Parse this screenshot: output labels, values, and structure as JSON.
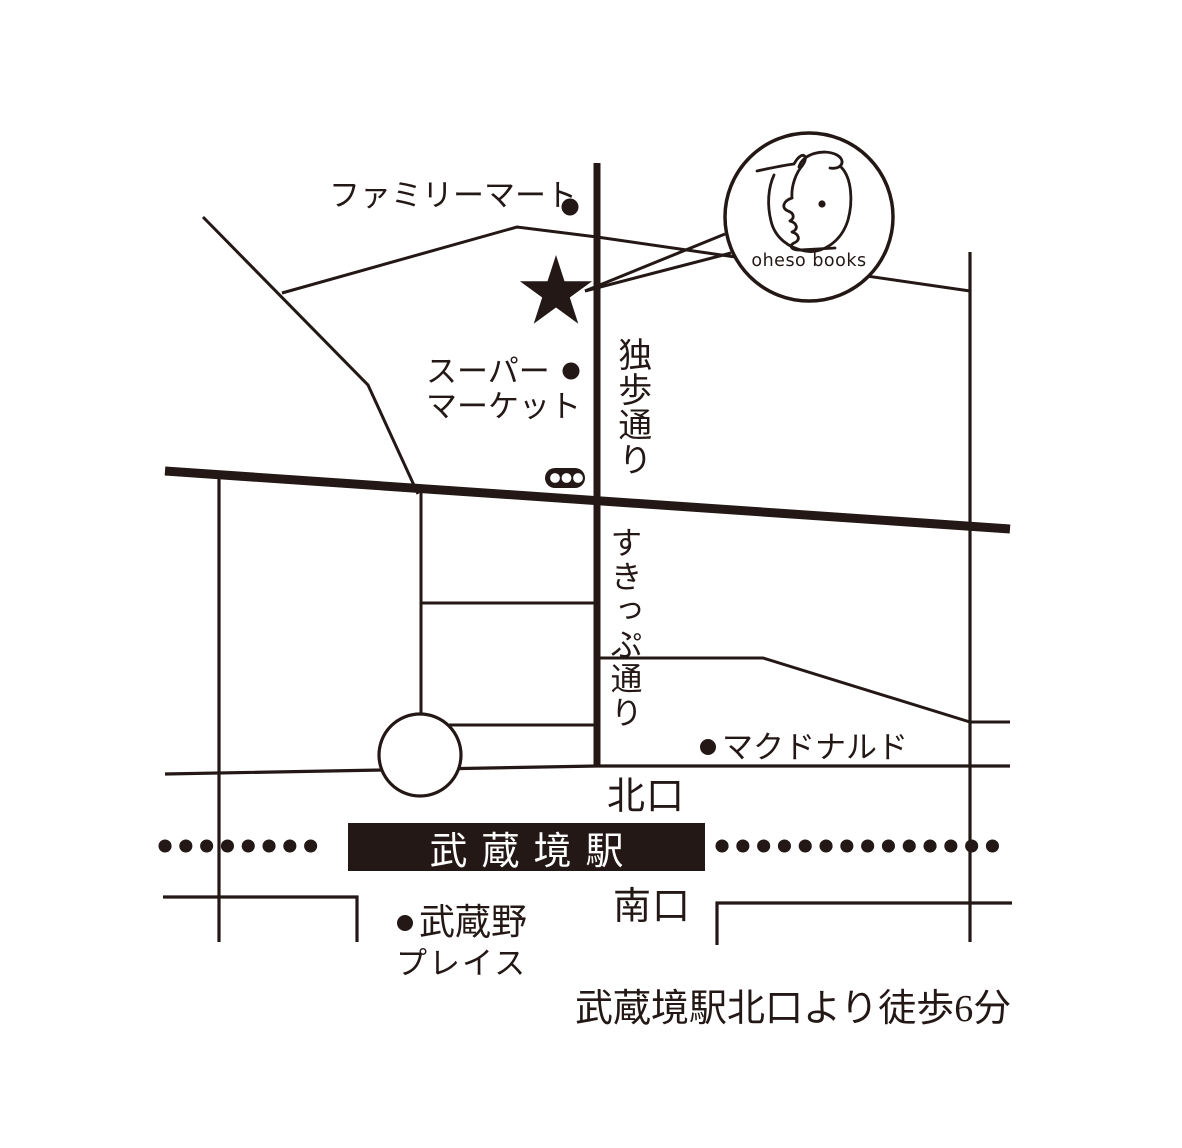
{
  "colors": {
    "ink": "#231815",
    "paper": "#ffffff"
  },
  "shop": {
    "name": "oheso books"
  },
  "streets": {
    "doppo_dori": "独歩通り",
    "skip_dori": "すきっぷ通り"
  },
  "station": {
    "name": "武蔵境駅",
    "north_exit": "北口",
    "south_exit": "南口"
  },
  "landmarks": {
    "familymart": "ファミリーマート",
    "supermarket_line1": "スーパー",
    "supermarket_line2": "マーケット",
    "mcdonalds": "マクドナルド",
    "musashino_place_line1": "武蔵野",
    "musashino_place_line2": "プレイス"
  },
  "footer": {
    "access_note": "武蔵境駅北口より徒歩6分"
  }
}
